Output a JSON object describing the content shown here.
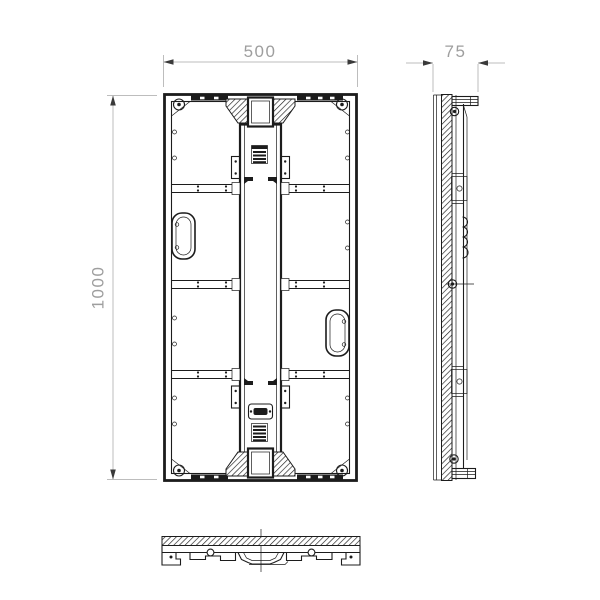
{
  "drawing": {
    "dimensions": {
      "width_label": "500",
      "height_label": "1000",
      "depth_label": "75"
    },
    "colors": {
      "background": "#ffffff",
      "line": "#1c1c1c",
      "dimension_line": "#bdbdbd",
      "dimension_text": "#9e9e9e",
      "arrow": "#3a3a3a"
    }
  }
}
